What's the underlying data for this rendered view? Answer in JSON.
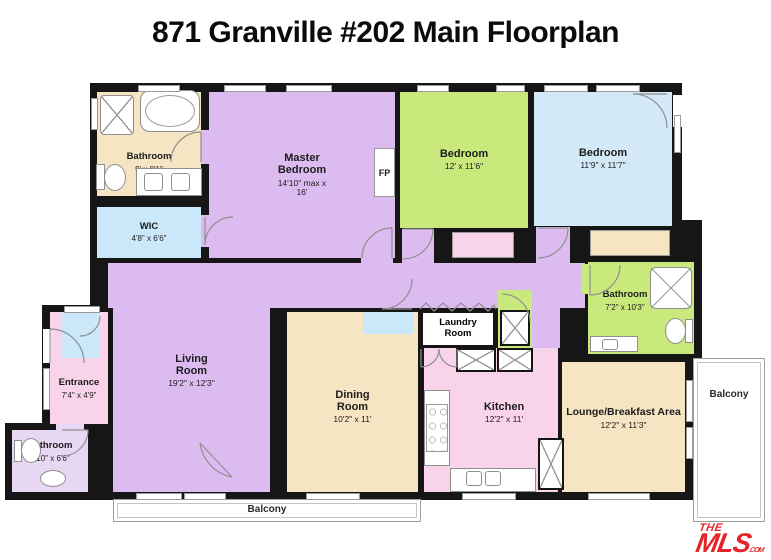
{
  "title": "871 Granville #202 Main Floorplan",
  "colors": {
    "wall": "#161616",
    "tan": "#f6e5c2",
    "purple": "#dcbcf0",
    "green": "#c9e97c",
    "blue": "#d4e9f7",
    "light_blue": "#cbe8fb",
    "pink": "#f8d3e9",
    "lavender": "#e8d7f3",
    "logo_red": "#e52329"
  },
  "rooms": {
    "bathroom_master": {
      "name": "Bathroom",
      "dims": "9' x 9'1\""
    },
    "wic": {
      "name": "WIC",
      "dims": "4'8\" x 6'6\""
    },
    "master_bedroom": {
      "name": "Master Bedroom",
      "dims": "14'10\" max x 16'"
    },
    "fireplace": {
      "label": "FP"
    },
    "bedroom_center": {
      "name": "Bedroom",
      "dims": "12' x 11'6\""
    },
    "bedroom_right": {
      "name": "Bedroom",
      "dims": "11'9\" x 11'7\""
    },
    "bathroom_right": {
      "name": "Bathroom",
      "dims": "7'2\" x 10'3\""
    },
    "laundry": {
      "name": "Laundry Room"
    },
    "entrance": {
      "name": "Entrance",
      "dims": "7'4\" x 4'9\""
    },
    "bathroom_small": {
      "name": "Bathroom",
      "dims": "4'10\" x 6'6\""
    },
    "living": {
      "name": "Living Room",
      "dims": "19'2\" x 12'3\""
    },
    "dining": {
      "name": "Dining Room",
      "dims": "10'2\" x 11'"
    },
    "kitchen": {
      "name": "Kitchen",
      "dims": "12'2\" x 11'"
    },
    "lounge": {
      "name": "Lounge/Breakfast Area",
      "dims": "12'2\" x 11'3\""
    }
  },
  "balconies": {
    "bottom": "Balcony",
    "right": "Balcony"
  },
  "logo": {
    "the": "THE",
    "mls": "MLS",
    "com": ".COM"
  }
}
